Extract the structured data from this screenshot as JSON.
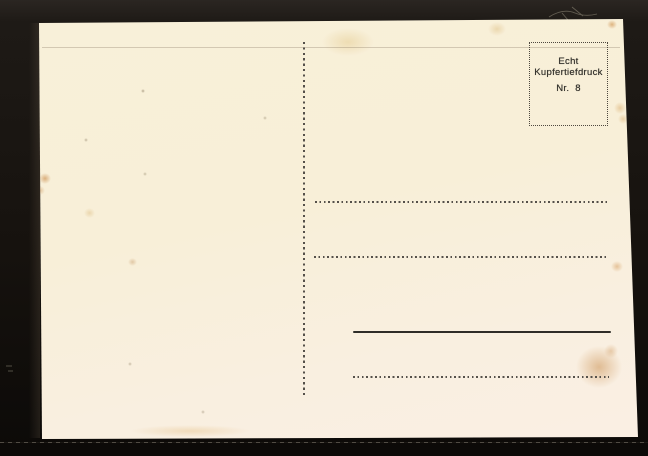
{
  "postcard": {
    "stamp_box": {
      "line1": "Echt",
      "line2": "Kupfertiefdruck",
      "number": "Nr. 8"
    },
    "colors": {
      "backdrop": "#17130f",
      "paper": "#f8efda",
      "ink": "#34322c",
      "ruled_line": "#55504a",
      "stain": "#cf9a5c"
    }
  }
}
